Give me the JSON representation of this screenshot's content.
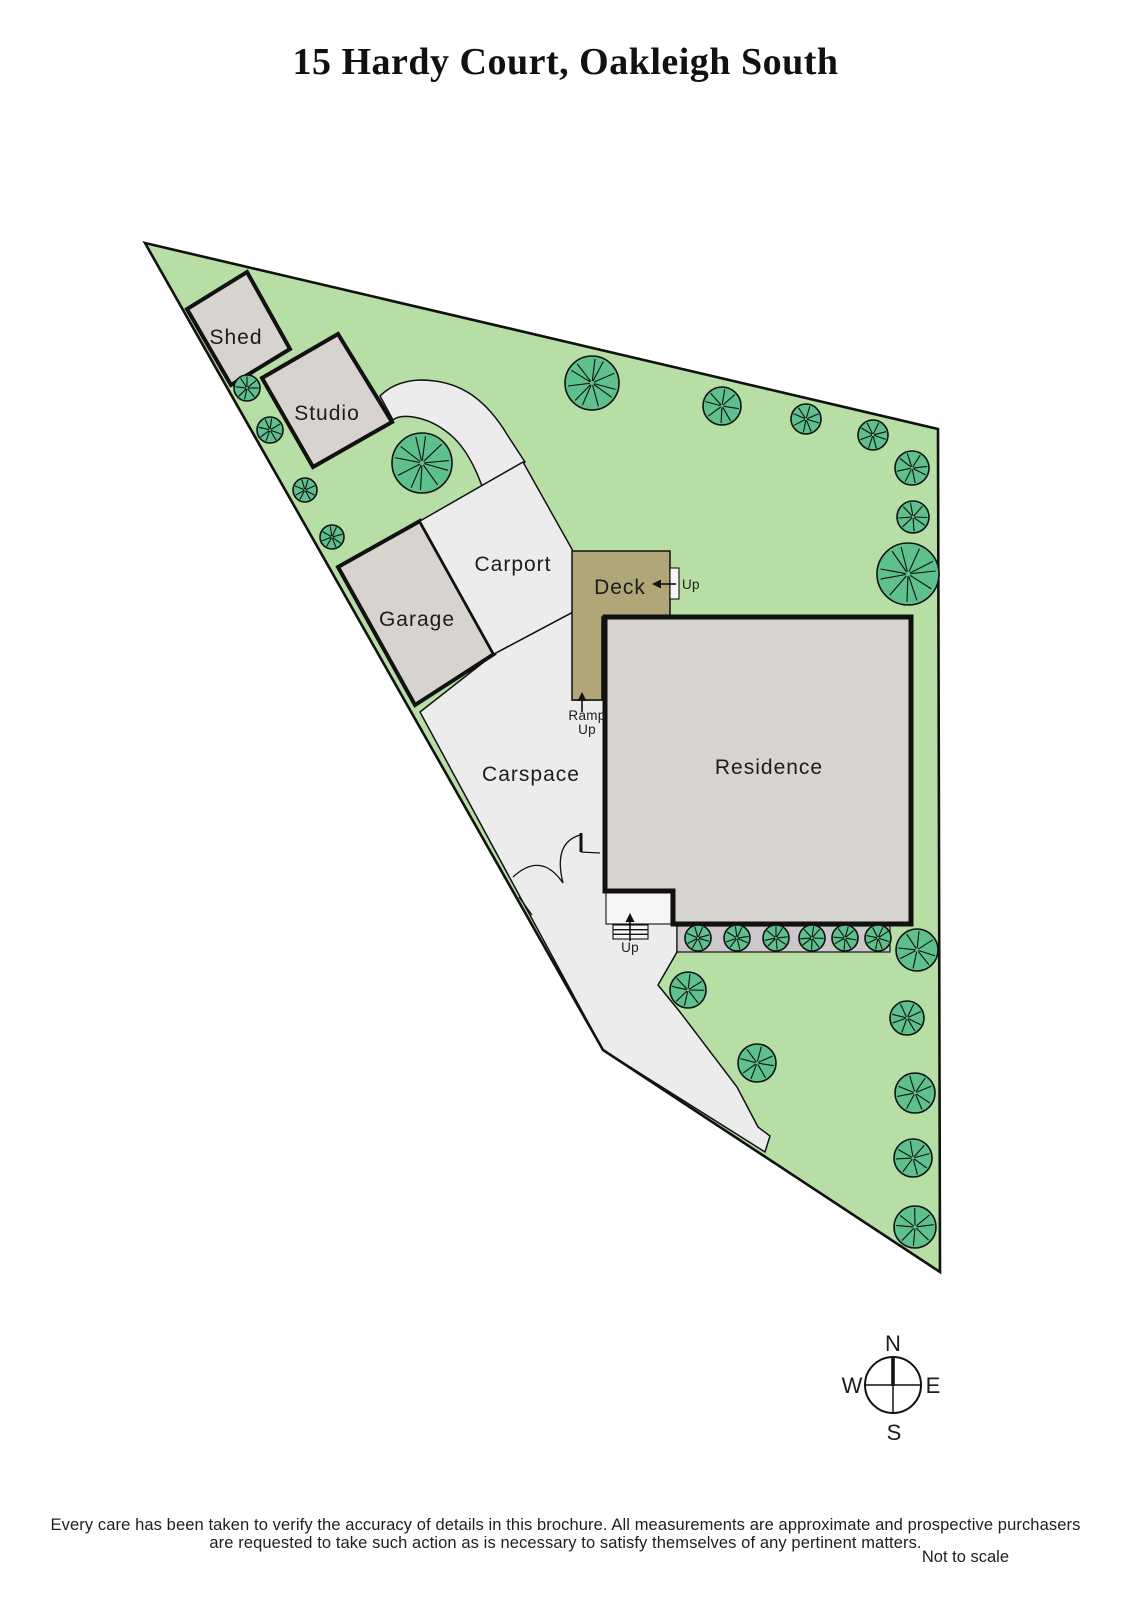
{
  "title": "15 Hardy Court, Oakleigh South",
  "plan": {
    "labels": {
      "shed": "Shed",
      "studio": "Studio",
      "garage": "Garage",
      "carport": "Carport",
      "deck": "Deck",
      "residence": "Residence",
      "carspace": "Carspace",
      "deck_up": "Up",
      "ramp_line1": "Ramp",
      "ramp_line2": "Up",
      "porch_up": "Up"
    },
    "colors": {
      "grass": "#b7dfa5",
      "tree": "#5ec08d",
      "building": "#d7d3cf",
      "light": "#ececec",
      "deck": "#b0a678",
      "strip": "#cbc7cb",
      "porch": "#f6f6f6",
      "line": "#111111"
    },
    "trees": [
      {
        "x": 247,
        "y": 388,
        "r": 13
      },
      {
        "x": 270,
        "y": 430,
        "r": 13
      },
      {
        "x": 305,
        "y": 490,
        "r": 12
      },
      {
        "x": 332,
        "y": 537,
        "r": 12
      },
      {
        "x": 422,
        "y": 463,
        "r": 30
      },
      {
        "x": 592,
        "y": 383,
        "r": 27
      },
      {
        "x": 722,
        "y": 406,
        "r": 19
      },
      {
        "x": 806,
        "y": 419,
        "r": 15
      },
      {
        "x": 873,
        "y": 435,
        "r": 15
      },
      {
        "x": 912,
        "y": 468,
        "r": 17
      },
      {
        "x": 913,
        "y": 517,
        "r": 16
      },
      {
        "x": 908,
        "y": 574,
        "r": 31
      },
      {
        "x": 917,
        "y": 950,
        "r": 21
      },
      {
        "x": 907,
        "y": 1018,
        "r": 17
      },
      {
        "x": 915,
        "y": 1093,
        "r": 20
      },
      {
        "x": 913,
        "y": 1158,
        "r": 19
      },
      {
        "x": 915,
        "y": 1227,
        "r": 21
      },
      {
        "x": 688,
        "y": 990,
        "r": 18
      },
      {
        "x": 757,
        "y": 1063,
        "r": 19
      }
    ],
    "bushes": [
      {
        "x": 698,
        "y": 938,
        "r": 13
      },
      {
        "x": 737,
        "y": 938,
        "r": 13
      },
      {
        "x": 776,
        "y": 938,
        "r": 13
      },
      {
        "x": 812,
        "y": 938,
        "r": 13
      },
      {
        "x": 845,
        "y": 938,
        "r": 13
      },
      {
        "x": 878,
        "y": 938,
        "r": 13
      }
    ]
  },
  "compass": {
    "n": "N",
    "s": "S",
    "e": "E",
    "w": "W"
  },
  "footer": {
    "line1": "Every care has been taken to verify the accuracy of details in this brochure.  All measurements are approximate and prospective purchasers",
    "line2": "are requested to take such action as is necessary to satisfy themselves of any pertinent matters.",
    "scale_note": "Not to scale"
  }
}
